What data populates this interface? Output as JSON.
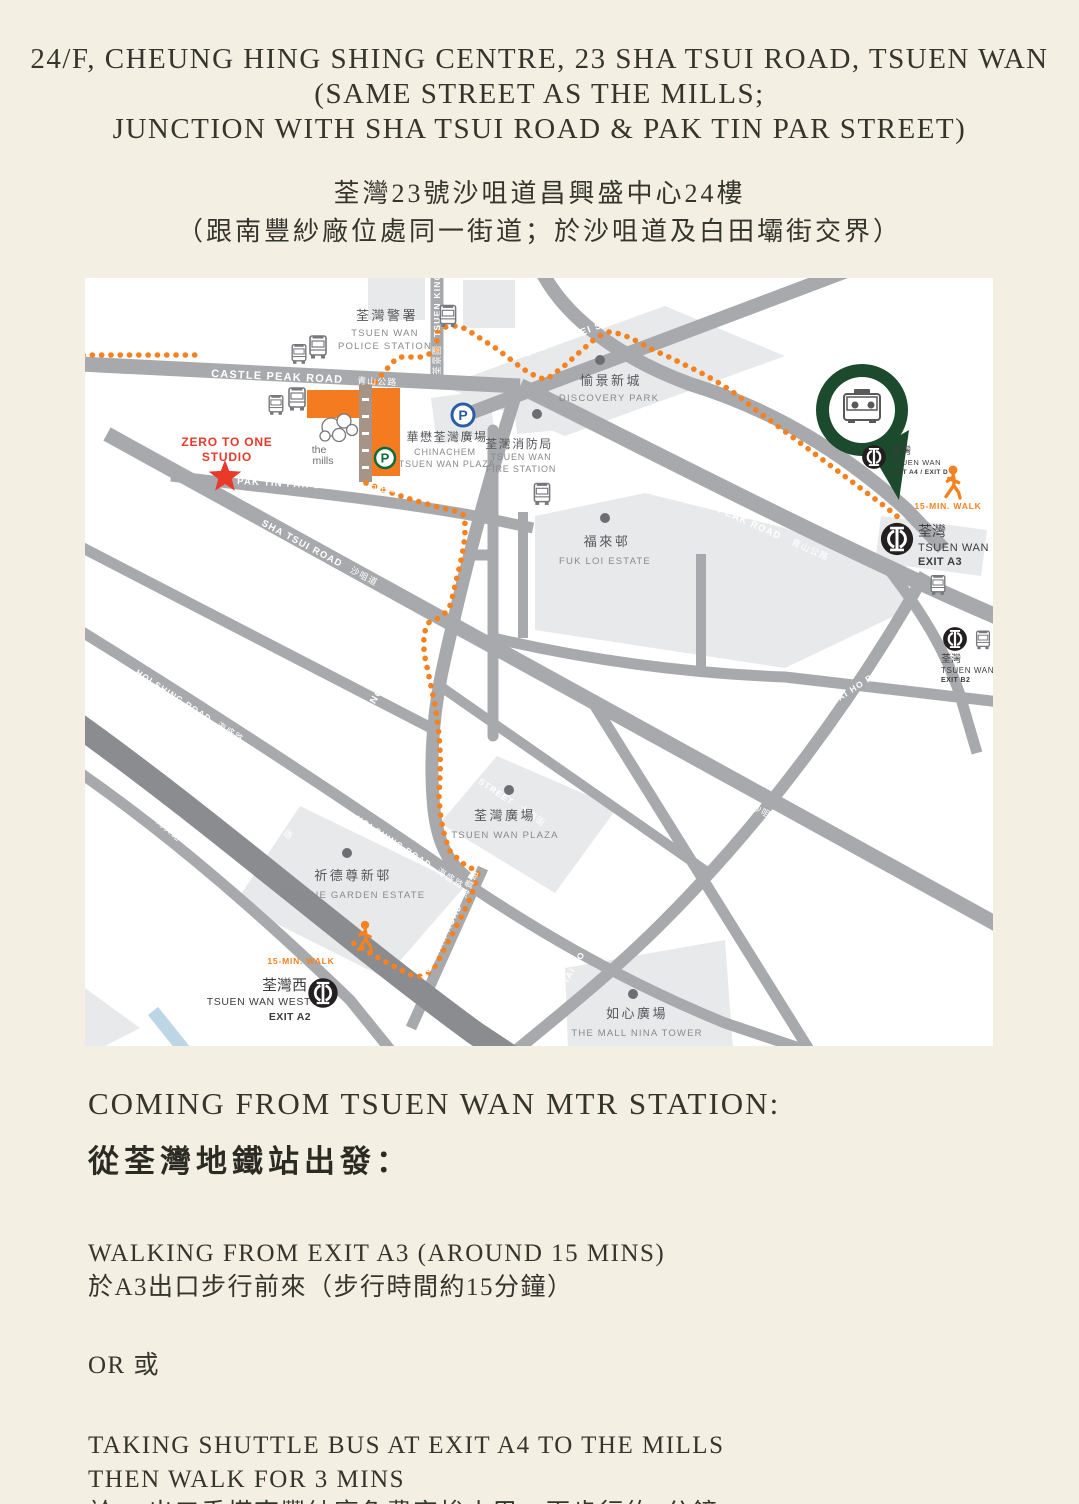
{
  "header": {
    "line1": "24/F, CHEUNG HING SHING CENTRE, 23 SHA TSUI ROAD, TSUEN WAN",
    "line2": "(SAME STREET AS THE MILLS;",
    "line3": "JUNCTION WITH SHA TSUI ROAD & PAK TIN PAR STREET)",
    "zh1": "荃灣23號沙咀道昌興盛中心24樓",
    "zh2": "（跟南豐紗廠位處同一街道；於沙咀道及白田壩街交界）"
  },
  "map": {
    "roads": {
      "castle_peak": "CASTLE PEAK ROAD",
      "castle_peak_zh": "青山公路",
      "tsuen_king": "TSUEN KING CIR.",
      "tsuen_king_zh": "荃景圍",
      "cheung_pei_shan": "CHEUNG PEI SHAN ROAD",
      "cheung_pei_shan_zh": "象鼻山路",
      "pak_tin_par": "PAK TIN PAR STREET",
      "pak_tin_par_zh": "白田壩街",
      "sha_tsui": "SHA TSUI ROAD",
      "sha_tsui_zh": "沙咀道",
      "chai_wan_kok": "CHAI WAN KOK STREET",
      "chai_wan_kok_zh": "柴灣角街",
      "hoi_shing": "HOI SHING ROAD",
      "hoi_shing_zh": "海盛路",
      "tsuen_wan_road": "TSUEN WAN ROAD",
      "tsuen_wan_road_zh": "荃灣路",
      "hoi_hing": "HOI HING ROAD",
      "hoi_hing_zh": "海興路",
      "tai_chung": "TAI CHUNG ROAD",
      "tai_chung_zh": "大涌道",
      "tai_pa": "TAI PA STREET",
      "tai_pa_zh": "大壩街",
      "hoi_kwai": "HOI KWAI ROAD",
      "hoi_kwai_zh": "海貴路",
      "tai_ho": "TAI HO ROAD",
      "tai_ho_zh": "大河道"
    },
    "places": {
      "police_zh": "荃灣警署",
      "police_en1": "TSUEN WAN",
      "police_en2": "POLICE STATION",
      "discovery_zh": "愉景新城",
      "discovery_en": "DISCOVERY PARK",
      "chinachem_zh": "華懋荃灣廣場",
      "chinachem_en1": "CHINACHEM",
      "chinachem_en2": "TSUEN WAN PLAZA",
      "fire_zh": "荃灣消防局",
      "fire_en1": "TSUEN WAN",
      "fire_en2": "FIRE STATION",
      "fukloi_zh": "福來邨",
      "fukloi_en": "FUK LOI ESTATE",
      "plaza_zh": "荃灣廣場",
      "plaza_en": "TSUEN WAN PLAZA",
      "clague_zh": "祈德尊新邨",
      "clague_en": "CLAGUE GARDEN ESTATE",
      "nina_zh": "如心廣場",
      "nina_en": "THE MALL NINA TOWER"
    },
    "stations": {
      "a4_zh": "荃灣",
      "a4_en": "TSUEN WAN",
      "a4_exit": "EXIT A4 / EXIT D",
      "a3_zh": "荃灣",
      "a3_en": "TSUEN WAN",
      "a3_exit": "EXIT A3",
      "b2_zh": "荃灣",
      "b2_en": "TSUEN WAN",
      "b2_exit": "EXIT B2",
      "west_zh": "荃灣西",
      "west_en": "TSUEN WAN WEST",
      "west_exit": "EXIT A2"
    },
    "badges": {
      "walk": "15-MIN. WALK"
    },
    "studio": {
      "line1": "ZERO TO ONE",
      "line2": "STUDIO"
    },
    "mills": {
      "line1": "the",
      "line2": "mills"
    },
    "parking_letter": "P",
    "colors": {
      "route_orange": "#F58220",
      "studio_red": "#E8392B",
      "pin_green": "#1B4A2C",
      "road_gray": "#A7A9AC",
      "highway_gray": "#8A8C8F",
      "block_gray": "#E8E9EA",
      "mtr_black": "#231F20",
      "parking_green": "#0B6B3A",
      "parking_blue": "#2A5CA8",
      "page_cream": "#F4EFE3"
    }
  },
  "directions": {
    "heading_en": "COMING FROM TSUEN WAN MTR STATION:",
    "heading_zh": "從荃灣地鐵站出發：",
    "opt1_en": "WALKING FROM EXIT A3 (AROUND 15 MINS)",
    "opt1_zh": "於A3出口步行前來（步行時間約15分鐘）",
    "or_label": "OR 或",
    "opt2_en1": "TAKING SHUTTLE BUS AT EXIT A4 TO THE MILLS",
    "opt2_en2": "THEN WALK FOR 3 MINS",
    "opt2_zh": "於A4出口乘搭南豐紗廠免費穿梭小巴，再步行約3分鐘"
  }
}
